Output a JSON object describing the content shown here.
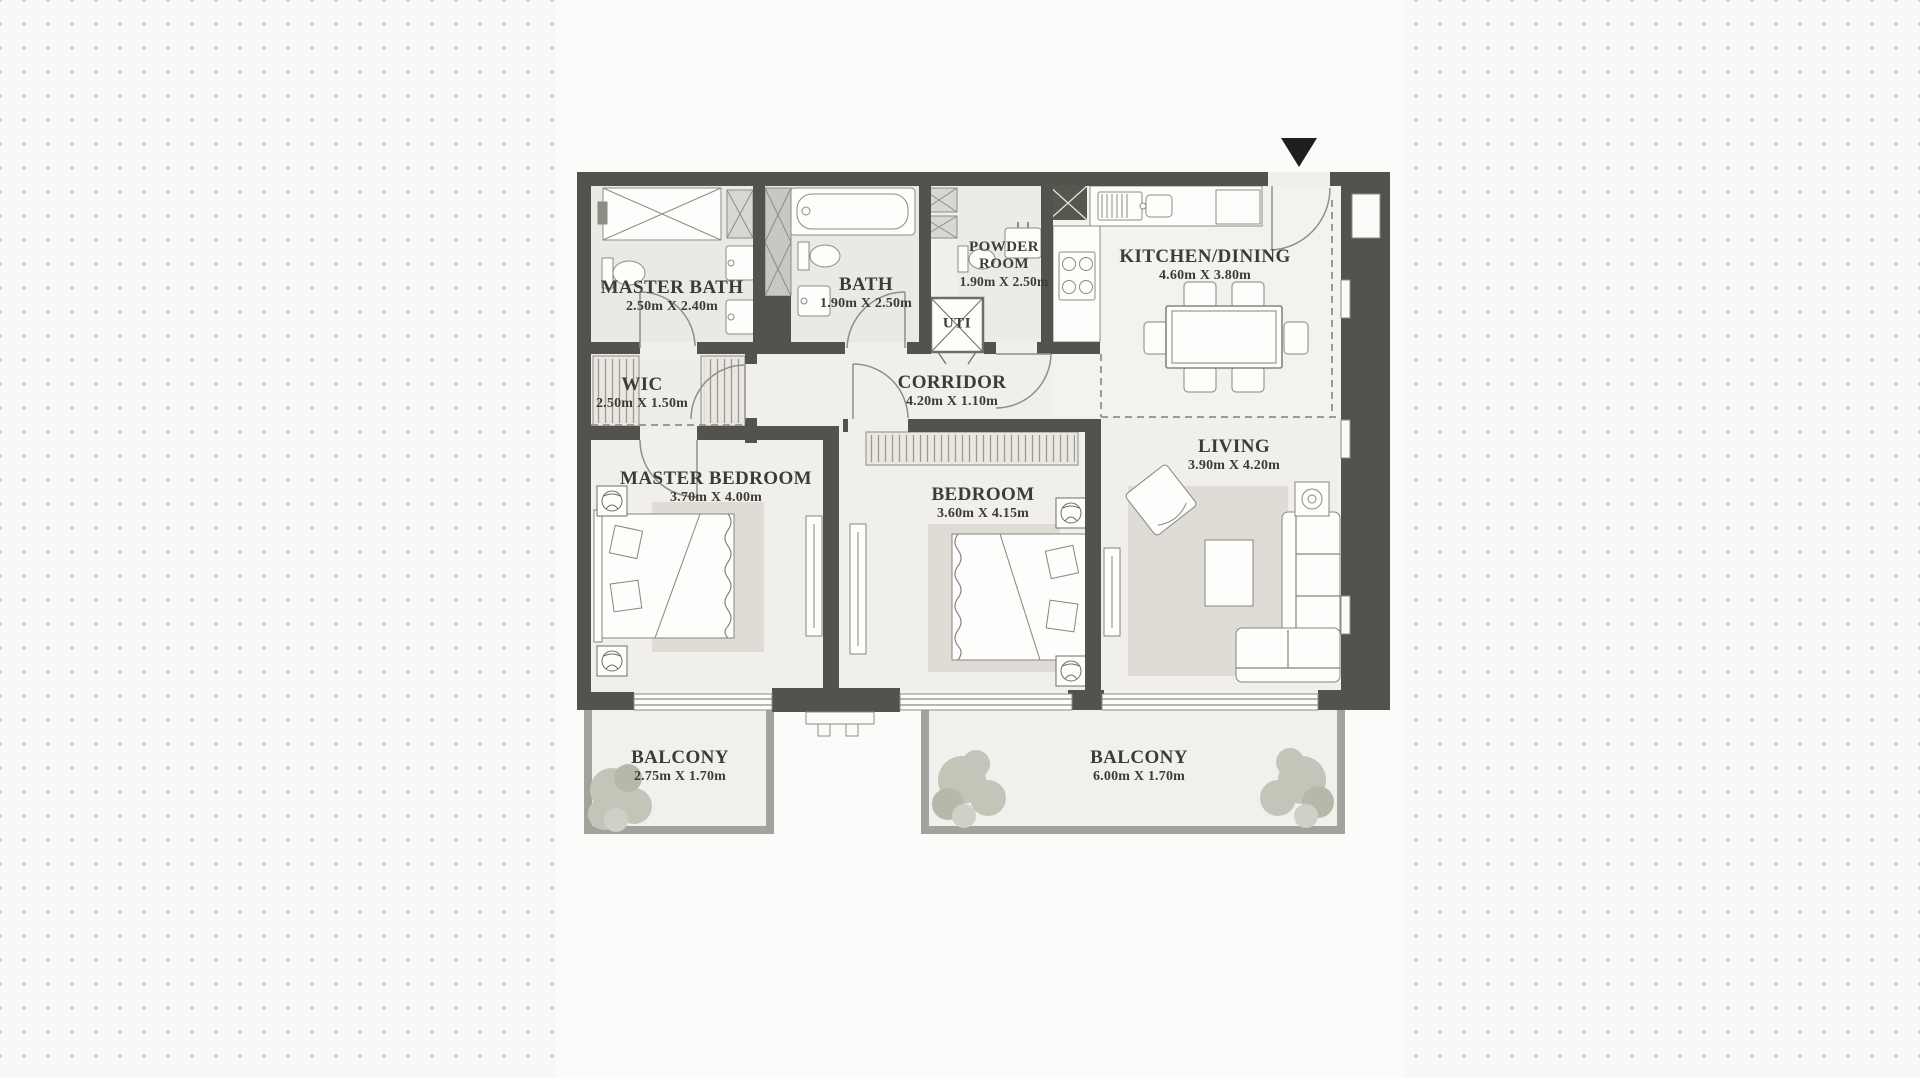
{
  "page": {
    "background_color": "#f8f8f7",
    "dot_color": "#c6c6c6",
    "panel_color": "#fbfbfa",
    "wall_color": "#53524d",
    "entrance_marker": "entrance-arrow-down"
  },
  "plan": {
    "rooms": [
      {
        "id": "master-bath",
        "name": "MASTER BATH",
        "dims": "2.50m X 2.40m"
      },
      {
        "id": "bath",
        "name": "BATH",
        "dims": "1.90m X 2.50m"
      },
      {
        "id": "powder-room",
        "name": "POWDER ROOM",
        "dims": "1.90m X 2.50m"
      },
      {
        "id": "utility",
        "name": "UTI",
        "dims": ""
      },
      {
        "id": "kitchen-dining",
        "name": "KITCHEN/DINING",
        "dims": "4.60m X 3.80m"
      },
      {
        "id": "corridor",
        "name": "CORRIDOR",
        "dims": "4.20m X 1.10m"
      },
      {
        "id": "wic",
        "name": "WIC",
        "dims": "2.50m X 1.50m"
      },
      {
        "id": "master-bedroom",
        "name": "MASTER BEDROOM",
        "dims": "3.70m X 4.00m"
      },
      {
        "id": "bedroom",
        "name": "BEDROOM",
        "dims": "3.60m X 4.15m"
      },
      {
        "id": "living",
        "name": "LIVING",
        "dims": "3.90m X 4.20m"
      },
      {
        "id": "balcony-left",
        "name": "BALCONY",
        "dims": "2.75m X 1.70m"
      },
      {
        "id": "balcony-right",
        "name": "BALCONY",
        "dims": "6.00m X 1.70m"
      }
    ]
  }
}
